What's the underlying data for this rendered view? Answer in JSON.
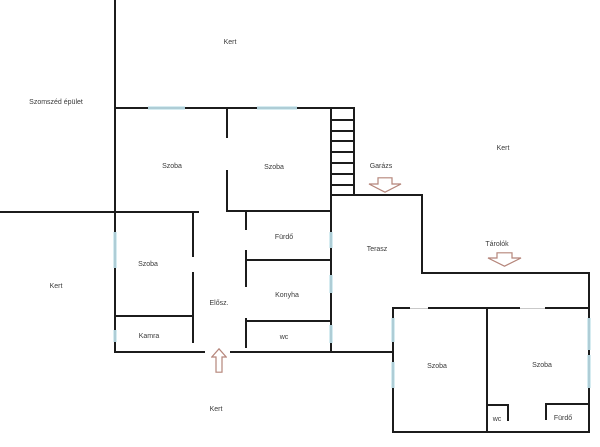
{
  "plan": {
    "title": "floor-plan",
    "areas": {
      "kert_top": "Kert",
      "kert_right": "Kert",
      "kert_left": "Kert",
      "kert_bottom": "Kert",
      "szomszed_epulet": "Szomszéd épület",
      "szoba_top_left": "Szoba",
      "szoba_top_right": "Szoba",
      "szoba_middle_left": "Szoba",
      "kamra": "Kamra",
      "eloszoba": "Elősz.",
      "furdo": "Fürdő",
      "konyha": "Konyha",
      "wc": "wc",
      "terasz": "Terasz",
      "garazs": "Garázs",
      "tarolok": "Tárolók",
      "szoba_bottom_left": "Szoba",
      "szoba_bottom_right": "Szoba",
      "wc_bottom": "wc",
      "furdo_bottom": "Fürdő"
    },
    "icons": {
      "garage_entrance": "down-block-arrow",
      "storage_entrance": "down-block-arrow",
      "main_entrance": "up-block-arrow"
    },
    "colors": {
      "wall": "#1c1c1c",
      "window_fill": "#d6ecf1",
      "window_frame": "#86aebb",
      "door_opening": "#c9c9c9",
      "arrow_outline": "#b5857a",
      "text": "#3a3a3a",
      "background": "#ffffff"
    }
  }
}
